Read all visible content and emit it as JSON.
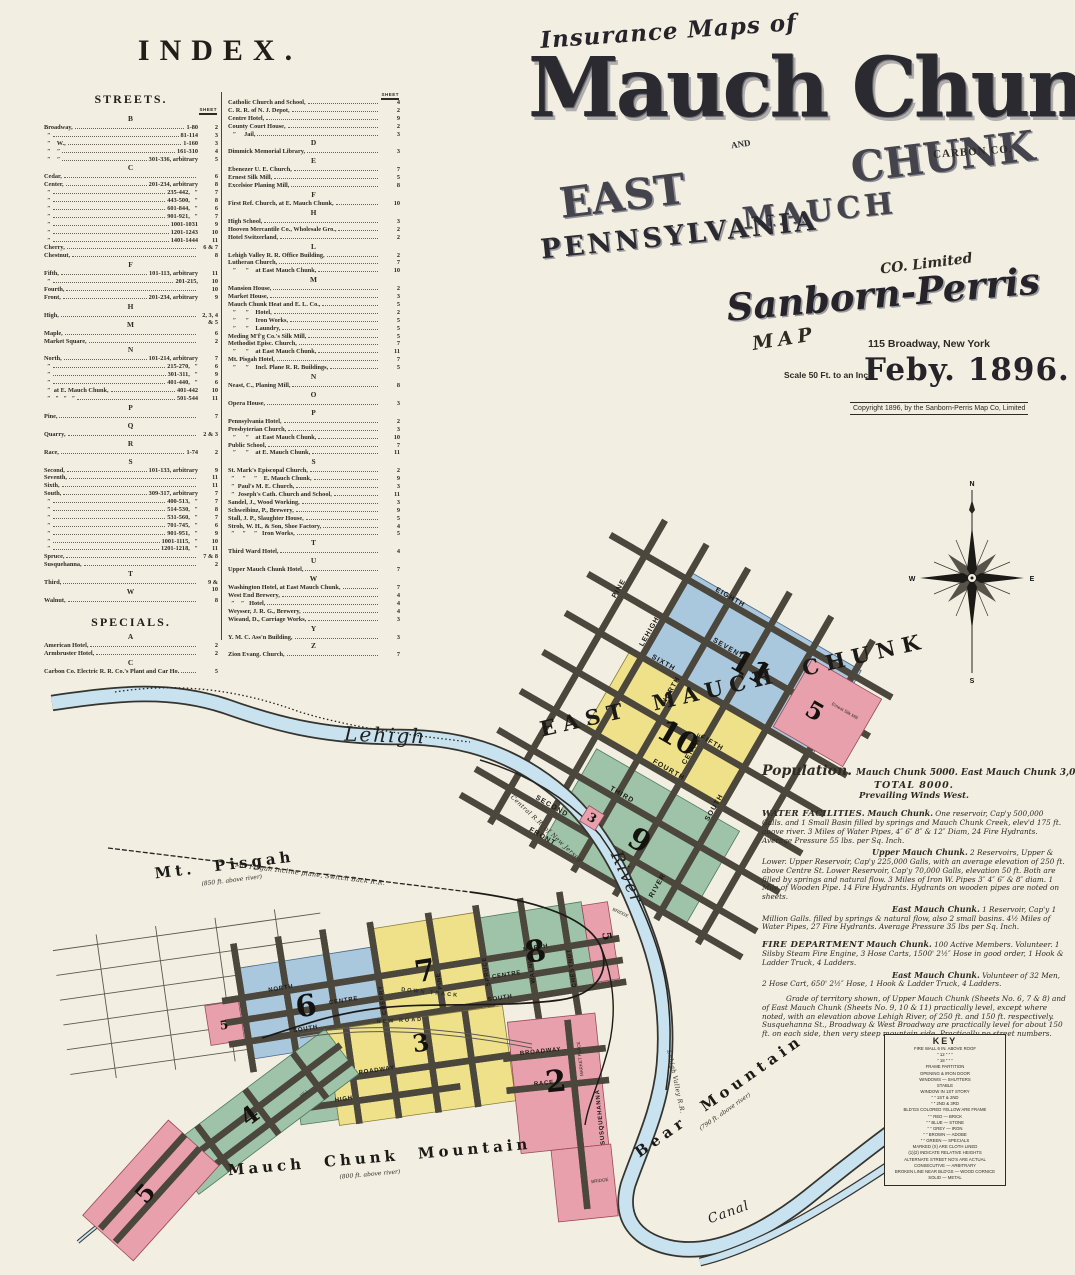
{
  "index": {
    "title": "INDEX.",
    "streets_heading": "STREETS.",
    "specials_heading": "SPECIALS.",
    "sheet_col": "SHEET",
    "streets": [
      {
        "cls": "sec",
        "label": "B"
      },
      {
        "label": "Broadway,",
        "mid": "1-80",
        "sheet": "2"
      },
      {
        "label": "  ″",
        "mid": "81-114",
        "sheet": "3"
      },
      {
        "label": "  ″    W.,",
        "mid": "1-160",
        "sheet": "3"
      },
      {
        "label": "  ″    ″",
        "mid": "161-310",
        "sheet": "4"
      },
      {
        "label": "  ″    ″",
        "mid": "301-336, arbitrary",
        "sheet": "5"
      },
      {
        "cls": "sec",
        "label": "C"
      },
      {
        "label": "Cedar,",
        "sheet": "6"
      },
      {
        "label": "Center,",
        "mid": "201-234, arbitrary",
        "sheet": "8"
      },
      {
        "label": "  ″",
        "mid": "235-442,   ″",
        "sheet": "7"
      },
      {
        "label": "  ″",
        "mid": "443-500,   ″",
        "sheet": "8"
      },
      {
        "label": "  ″",
        "mid": "601-844,   ″",
        "sheet": "6"
      },
      {
        "label": "  ″",
        "mid": "901-921,   ″",
        "sheet": "7"
      },
      {
        "label": "  ″",
        "mid": "1001-1031",
        "sheet": "9"
      },
      {
        "label": "  ″",
        "mid": "1201-1243",
        "sheet": "10"
      },
      {
        "label": "  ″",
        "mid": "1401-1444",
        "sheet": "11"
      },
      {
        "label": "Cherry,",
        "sheet": "6 & 7"
      },
      {
        "label": "Chestnut,",
        "sheet": "8"
      },
      {
        "cls": "sec",
        "label": "F"
      },
      {
        "label": "Fifth,",
        "mid": "101-113, arbitrary",
        "sheet": "11"
      },
      {
        "label": "  ″",
        "mid": "201-215,",
        "sheet": "10"
      },
      {
        "label": "Fourth,",
        "sheet": "10"
      },
      {
        "label": "Front,",
        "mid": "201-234, arbitrary",
        "sheet": "9"
      },
      {
        "cls": "sec",
        "label": "H"
      },
      {
        "label": "High,",
        "sheet": "2, 3, 4 & 5"
      },
      {
        "cls": "sec",
        "label": "M"
      },
      {
        "label": "Maple,",
        "sheet": "6"
      },
      {
        "label": "Market Square,",
        "sheet": "2"
      },
      {
        "cls": "sec",
        "label": "N"
      },
      {
        "label": "North,",
        "mid": "101-214, arbitrary",
        "sheet": "7"
      },
      {
        "label": "  ″",
        "mid": "215-270,   ″",
        "sheet": "6"
      },
      {
        "label": "  ″",
        "mid": "301-311,   ″",
        "sheet": "9"
      },
      {
        "label": "  ″",
        "mid": "401-440,   ″",
        "sheet": "6"
      },
      {
        "label": "  ″  at E. Mauch Chunk,",
        "mid": "401-442",
        "sheet": "10"
      },
      {
        "label": "  ″   ″   ″   ″",
        "mid": "501-544",
        "sheet": "11"
      },
      {
        "cls": "sec",
        "label": "P"
      },
      {
        "label": "Pine,",
        "sheet": "7"
      },
      {
        "cls": "sec",
        "label": "Q"
      },
      {
        "label": "Quarry,",
        "sheet": "2 & 3"
      },
      {
        "cls": "sec",
        "label": "R"
      },
      {
        "label": "Race,",
        "mid": "1-74",
        "sheet": "2"
      },
      {
        "cls": "sec",
        "label": "S"
      },
      {
        "label": "Second,",
        "mid": "101-133, arbitrary",
        "sheet": "9"
      },
      {
        "label": "Seventh,",
        "sheet": "11"
      },
      {
        "label": "Sixth,",
        "sheet": "11"
      },
      {
        "label": "South,",
        "mid": "309-317, arbitrary",
        "sheet": "7"
      },
      {
        "label": "  ″",
        "mid": "400-513,   ″",
        "sheet": "7"
      },
      {
        "label": "  ″",
        "mid": "514-530,   ″",
        "sheet": "8"
      },
      {
        "label": "  ″",
        "mid": "531-560,   ″",
        "sheet": "7"
      },
      {
        "label": "  ″",
        "mid": "701-745,   ″",
        "sheet": "6"
      },
      {
        "label": "  ″",
        "mid": "901-951,   ″",
        "sheet": "9"
      },
      {
        "label": "  ″",
        "mid": "1001-1115,   ″",
        "sheet": "10"
      },
      {
        "label": "  ″",
        "mid": "1201-1218,   ″",
        "sheet": "11"
      },
      {
        "label": "Spruce,",
        "sheet": "7 & 8"
      },
      {
        "label": "Susquehanna,",
        "sheet": "2"
      },
      {
        "cls": "sec",
        "label": "T"
      },
      {
        "label": "Third,",
        "sheet": "9 & 10"
      },
      {
        "cls": "sec",
        "label": "W"
      },
      {
        "label": "Walnut,",
        "sheet": "8"
      }
    ],
    "specials": [
      {
        "cls": "sec",
        "label": "A"
      },
      {
        "label": "American Hotel,",
        "sheet": "2"
      },
      {
        "label": "Armbruster Hotel,",
        "sheet": "2"
      },
      {
        "cls": "sec",
        "label": "C"
      },
      {
        "label": "Carbon Co. Electric R. R. Co.'s Plant and Car Ho.",
        "sheet": "5"
      }
    ],
    "buildings": [
      {
        "label": "Catholic Church and School,",
        "sheet": "4"
      },
      {
        "label": "C. R. R. of N. J. Depot,",
        "sheet": "2"
      },
      {
        "label": "Centre Hotel,",
        "sheet": "9"
      },
      {
        "label": "County Court House,",
        "sheet": "2"
      },
      {
        "label": "   ″     Jail,",
        "sheet": "3"
      },
      {
        "cls": "sec",
        "label": "D"
      },
      {
        "label": "Dimmick Memorial Library,",
        "sheet": "3"
      },
      {
        "cls": "sec",
        "label": "E"
      },
      {
        "label": "Ebenezer U. E. Church,",
        "sheet": "7"
      },
      {
        "label": "Ernest Silk Mill,",
        "sheet": "5"
      },
      {
        "label": "Excelsior Planing Mill,",
        "sheet": "8"
      },
      {
        "cls": "sec",
        "label": "F"
      },
      {
        "label": "First Ref. Church, at E. Mauch Chunk,",
        "sheet": "10"
      },
      {
        "cls": "sec",
        "label": "H"
      },
      {
        "label": "High School,",
        "sheet": "3"
      },
      {
        "label": "Hooven Mercantile Co., Wholesale Gro.,",
        "sheet": "2"
      },
      {
        "label": "Hotel Switzerland,",
        "sheet": "2"
      },
      {
        "cls": "sec",
        "label": "L"
      },
      {
        "label": "Lehigh Valley R. R. Office Building,",
        "sheet": "2"
      },
      {
        "label": "Lutheran Church,",
        "sheet": "7"
      },
      {
        "label": "   ″      ″    at East Mauch Chunk,",
        "sheet": "10"
      },
      {
        "cls": "sec",
        "label": "M"
      },
      {
        "label": "Mansion House,",
        "sheet": "2"
      },
      {
        "label": "Market House,",
        "sheet": "3"
      },
      {
        "label": "Mauch Chunk Heat and E. L. Co.,",
        "sheet": "5"
      },
      {
        "label": "   ″      ″    Hotel,",
        "sheet": "2"
      },
      {
        "label": "   ″      ″    Iron Works,",
        "sheet": "5"
      },
      {
        "label": "   ″      ″    Laundry,",
        "sheet": "5"
      },
      {
        "label": "Meding M'f'g Co.'s Silk Mill,",
        "sheet": "5"
      },
      {
        "label": "Methodist Episc. Church,",
        "sheet": "7"
      },
      {
        "label": "   ″      ″    at East Mauch Chunk,",
        "sheet": "11"
      },
      {
        "label": "Mt. Pisgah Hotel,",
        "sheet": "7"
      },
      {
        "label": "   ″      ″    Incl. Plane R. R. Buildings,",
        "sheet": "5"
      },
      {
        "cls": "sec",
        "label": "N"
      },
      {
        "label": "Neast, C., Planing Mill,",
        "sheet": "8"
      },
      {
        "cls": "sec",
        "label": "O"
      },
      {
        "label": "Opera House,",
        "sheet": "3"
      },
      {
        "cls": "sec",
        "label": "P"
      },
      {
        "label": "Pennsylvania Hotel,",
        "sheet": "2"
      },
      {
        "label": "Presbyterian Church,",
        "sheet": "3"
      },
      {
        "label": "   ″      ″    at East Mauch Chunk,",
        "sheet": "10"
      },
      {
        "label": "Public School,",
        "sheet": "7"
      },
      {
        "label": "   ″      ″    at E. Mauch Chunk,",
        "sheet": "11"
      },
      {
        "cls": "sec",
        "label": "S"
      },
      {
        "label": "St. Mark's Episcopal Church,",
        "sheet": "2"
      },
      {
        "label": "  ″     ″     ″    E. Mauch Chunk,",
        "sheet": "9"
      },
      {
        "label": "  ″  Paul's M. E. Church,",
        "sheet": "3"
      },
      {
        "label": "  ″  Joseph's Cath. Church and School,",
        "sheet": "11"
      },
      {
        "label": "Sandel, J., Wood Working,",
        "sheet": "3"
      },
      {
        "label": "Schweibinz, P., Brewery,",
        "sheet": "9"
      },
      {
        "label": "Stall, J. P., Slaughter House,",
        "sheet": "5"
      },
      {
        "label": "Stroh, W. H., & Son, Shoe Factory,",
        "sheet": "4"
      },
      {
        "label": "  ″     ″     ″   Iron Works,",
        "sheet": "5"
      },
      {
        "cls": "sec",
        "label": "T"
      },
      {
        "label": "Third Ward Hotel,",
        "sheet": "4"
      },
      {
        "cls": "sec",
        "label": "U"
      },
      {
        "label": "Upper Mauch Chunk Hotel,",
        "sheet": "7"
      },
      {
        "cls": "sec",
        "label": "W"
      },
      {
        "label": "Washington Hotel, at East Mauch Chunk,",
        "sheet": "7"
      },
      {
        "label": "West End Brewery,",
        "sheet": "4"
      },
      {
        "label": "  ″    ″   Hotel,",
        "sheet": "4"
      },
      {
        "label": "Weysser, J. R. G., Brewery,",
        "sheet": "4"
      },
      {
        "label": "Wieand, D., Carriage Works,",
        "sheet": "3"
      },
      {
        "cls": "sec",
        "label": "Y"
      },
      {
        "label": "Y. M. C. Ass'n Building,",
        "sheet": "3"
      },
      {
        "cls": "sec",
        "label": "Z"
      },
      {
        "label": "Zion Evang. Church,",
        "sheet": "7"
      }
    ]
  },
  "title": {
    "kicker": "Insurance Maps of",
    "main": "Mauch Chunk",
    "and": "AND",
    "east": "EAST",
    "chunk": "CHUNK",
    "mauch": "MAUCH",
    "carbon": "CARBON CO.",
    "state": "PENNSYLVANIA",
    "publisher": "Sanborn-Perris",
    "map_word": "MAP",
    "co_limited": "CO. Limited",
    "address": "115 Broadway, New York",
    "scale": "Scale 50 Ft. to an Inch",
    "date": "Feby. 1896.",
    "copyright": "Copyright 1896, by the Sanborn-Perris Map Co, Limited"
  },
  "notes": {
    "population_main": "Mauch Chunk 5000.  East Mauch Chunk 3,000.",
    "population_word": "Population.",
    "population_total": "TOTAL 8000.",
    "population_winds": "Prevailing Winds West.",
    "water_heading": "WATER FACILITIES.",
    "water_mc_label": "Mauch Chunk.",
    "water_mc_text": " One reservoir, Cap'y 500,000 Galls. and 1 Small Basin filled by springs and Mauch Chunk Creek, elev'd 175 ft. above river.  3 Miles of Water Pipes, 4″ 6″ 8″ & 12″ Diam, 24 Fire Hydrants. Average Pressure 55 lbs. per Sq. Inch.",
    "water_umc_label": "Upper Mauch Chunk.",
    "water_umc_text": " 2 Reservoirs, Upper & Lower. Upper Reservoir, Cap'y 225,000 Galls, with an average elevation of 250 ft. above Centre St.  Lower Reservoir, Cap'y 70,000 Galls, elevation 50 ft. Both are filled by springs and natural flow.  3 Miles of Iron W. Pipes 3″ 4″ 6″ & 8″ diam.  1 Mile of Wooden Pipe.  14 Fire Hydrants.  Hydrants on wooden pipes are noted on sheets.",
    "water_emc_label": "East Mauch Chunk.",
    "water_emc_text": " 1 Reservoir, Cap'y 1 Million Galls. filled by springs & natural flow, also 2 small basins.  4½ Miles of Water Pipes, 27 Fire Hydrants. Average Pressure 35 lbs per Sq. Inch.",
    "fire_heading": "FIRE DEPARTMENT",
    "fire_mc_label": " Mauch Chunk.",
    "fire_mc_text": " 100 Active Members. Volunteer. 1 Silsby Steam Fire Engine, 3 Hose Carts, 1500' 2½″ Hose in good order, 1 Hook & Ladder Truck, 4 Ladders.",
    "fire_emc_label": "East Mauch Chunk.",
    "fire_emc_text": " Volunteer of 32 Men, 2 Hose Cart, 650' 2½″ Hose, 1 Hook & Ladder Truck, 4 Ladders.",
    "grade_text": "Grade of territory shown, of Upper Mauch Chunk (Sheets No. 6, 7 & 8) and of East Mauch Chunk (Sheets No. 9, 10 & 11) practically level, except where noted, with an elevation above Lehigh River, of 250 ft. and 150 ft. respectively.  Susquehanna St., Broadway & West Broadway are practically level for about 150 ft. on each side, then very steep mountain side.  Practically no street numbers."
  },
  "key": {
    "title": "KEY",
    "lines": [
      "FIRE WALL 6 IN. ABOVE ROOF",
      "″   12 ″    ″    ″",
      "″   18 ″    ″    ″",
      "FRAME PARTITION",
      "OPENING & IRON DOOR",
      "WINDOWS — SHUTTERS",
      "STABLE",
      "WINDOW IN 1ST STORY",
      "″    ″  1ST & 2ND",
      "″    ″  2ND & 3RD",
      "BLD'GS COLORED YELLOW ARE FRAME",
      "″    ″    RED — BRICK",
      "″    ″    BLUE — STONE",
      "″    ″    GREY — IRON",
      "″    ″    BROWN — ADOBE",
      "″    ″    GREEN — SPECIALS",
      "MARKED (X) ARE CLOTH LINED",
      "(1)(2) INDICATE RELATIVE HEIGHTS",
      "ALTERNATE STREET NO'S ARE ACTUAL",
      "CONSECUTIVE — ARBITRARY",
      "BROKEN LINE NEAR BLD'GS — WOOD CORNICE",
      "SOLID — METAL"
    ]
  },
  "map": {
    "region_labels": {
      "east_mauch_chunk": "EAST MAUCH CHUNK",
      "lehigh": "Lehigh",
      "river": "River",
      "canal": "Canal",
      "mt_pisgah": "Mt. Pisgah",
      "mt_pisgah_elev": "(850 ft. above river)",
      "incline": "Mt. Pisgah Incline plane, Switch Back R.R.",
      "central_rr": "Central R.R. of New Jersey",
      "lehigh_valley_rr": "Lehigh Valley R.R.",
      "mauch_chunk_mtn": "Mauch Chunk Mountain",
      "mauch_chunk_mtn_elev": "(800 ft. above river)",
      "bear_mtn": "Bear Mountain",
      "bear_mtn_elev": "(790 ft. above river)",
      "new_road": "NEW ROAD",
      "down_track": "DOWN TRACK",
      "bridge": "BRIDGE",
      "silk_mill": "Ernest Silk Mill"
    },
    "districts": {
      "d2": "2",
      "d3": "3",
      "d4": "4",
      "d5": "5",
      "d6": "6",
      "d7": "7",
      "d8": "8",
      "d9": "9",
      "d10": "10",
      "d11": "11"
    },
    "streets": {
      "pine": "PINE",
      "lehigh": "LEHIGH",
      "north": "NORTH",
      "centre": "CENTRE",
      "south": "SOUTH",
      "river_st": "RIVER",
      "eighth": "EIGHTH",
      "seventh": "SEVENTH",
      "sixth": "SIXTH",
      "fifth": "FIFTH",
      "fourth": "FOURTH",
      "third": "THIRD",
      "second": "SECOND",
      "front": "FRONT",
      "cherry": "CHERRY",
      "spruce": "SPRUCE",
      "walnut": "WALNUT",
      "chestnut": "CHESTNUT",
      "poplar": "POPLAR",
      "broadway": "BROADWAY",
      "west": "WEST",
      "high": "HIGH",
      "race": "RACE",
      "market_place": "MARKET PLACE",
      "susquehanna": "SUSQUEHANNA",
      "hill": "HILL"
    },
    "compass": {
      "n": "N",
      "s": "S",
      "e": "E",
      "w": "W"
    },
    "colors": {
      "frame_yellow": "#efe18a",
      "brick_pink": "#e9a0ad",
      "stone_blue": "#a9c7dd",
      "specials_green": "#9fc3a9",
      "water": "#c9e2ef",
      "paper": "#f2eee1"
    }
  }
}
